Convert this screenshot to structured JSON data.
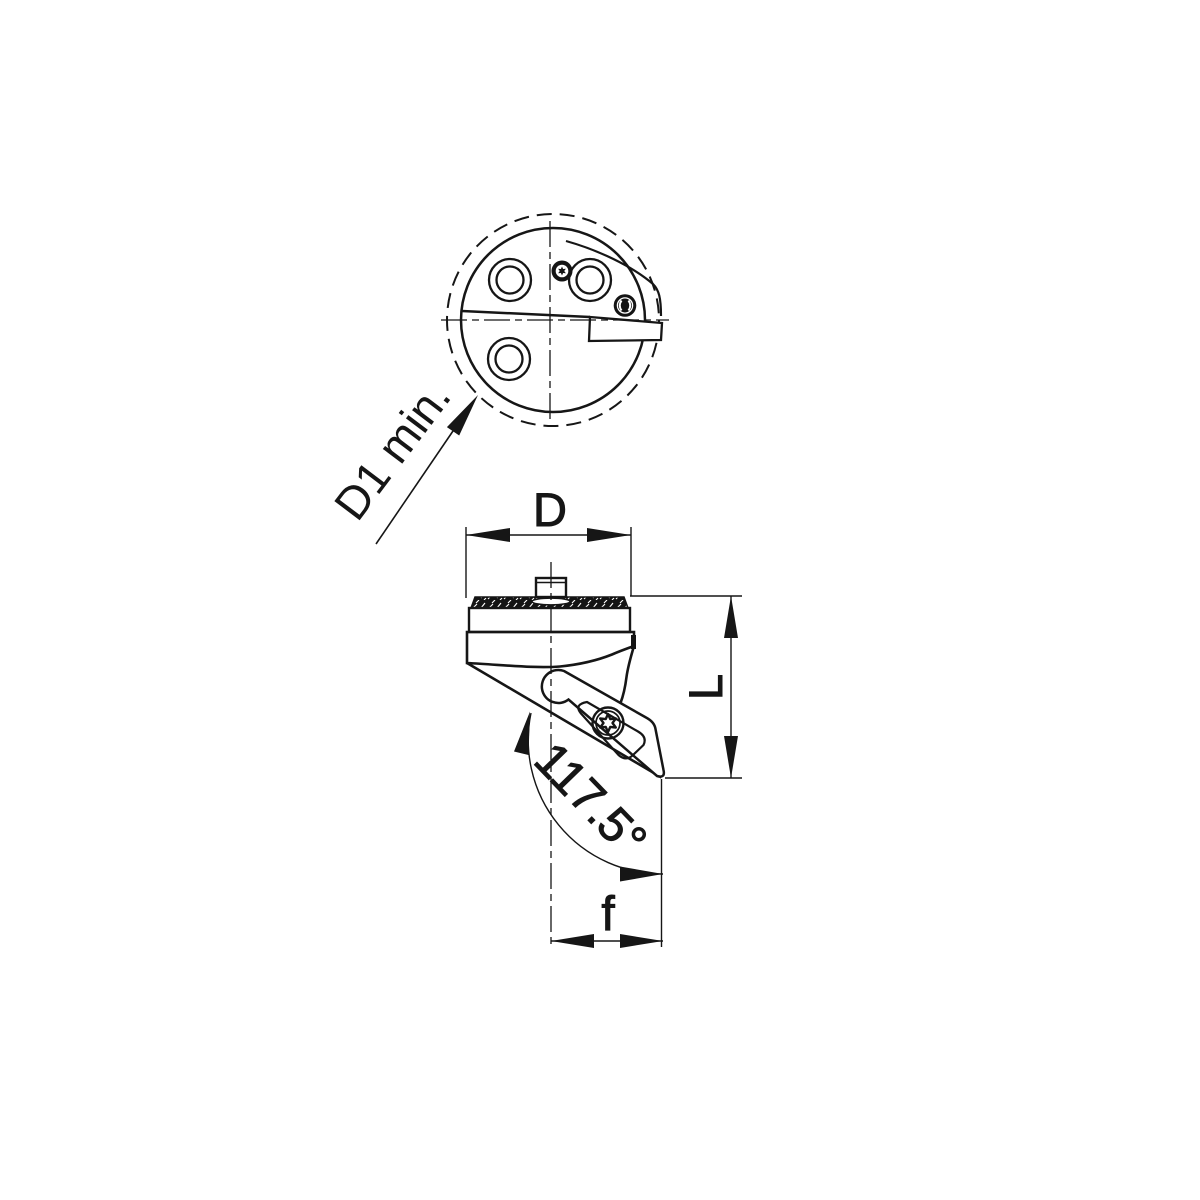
{
  "page": {
    "background": "#ffffff",
    "line_color": "#161616"
  },
  "drawing": {
    "labels": {
      "min_bore_diameter": "D1 min.",
      "head_diameter": "D",
      "head_length": "L",
      "tip_offset": "f",
      "head_angle": "117.5°"
    }
  }
}
